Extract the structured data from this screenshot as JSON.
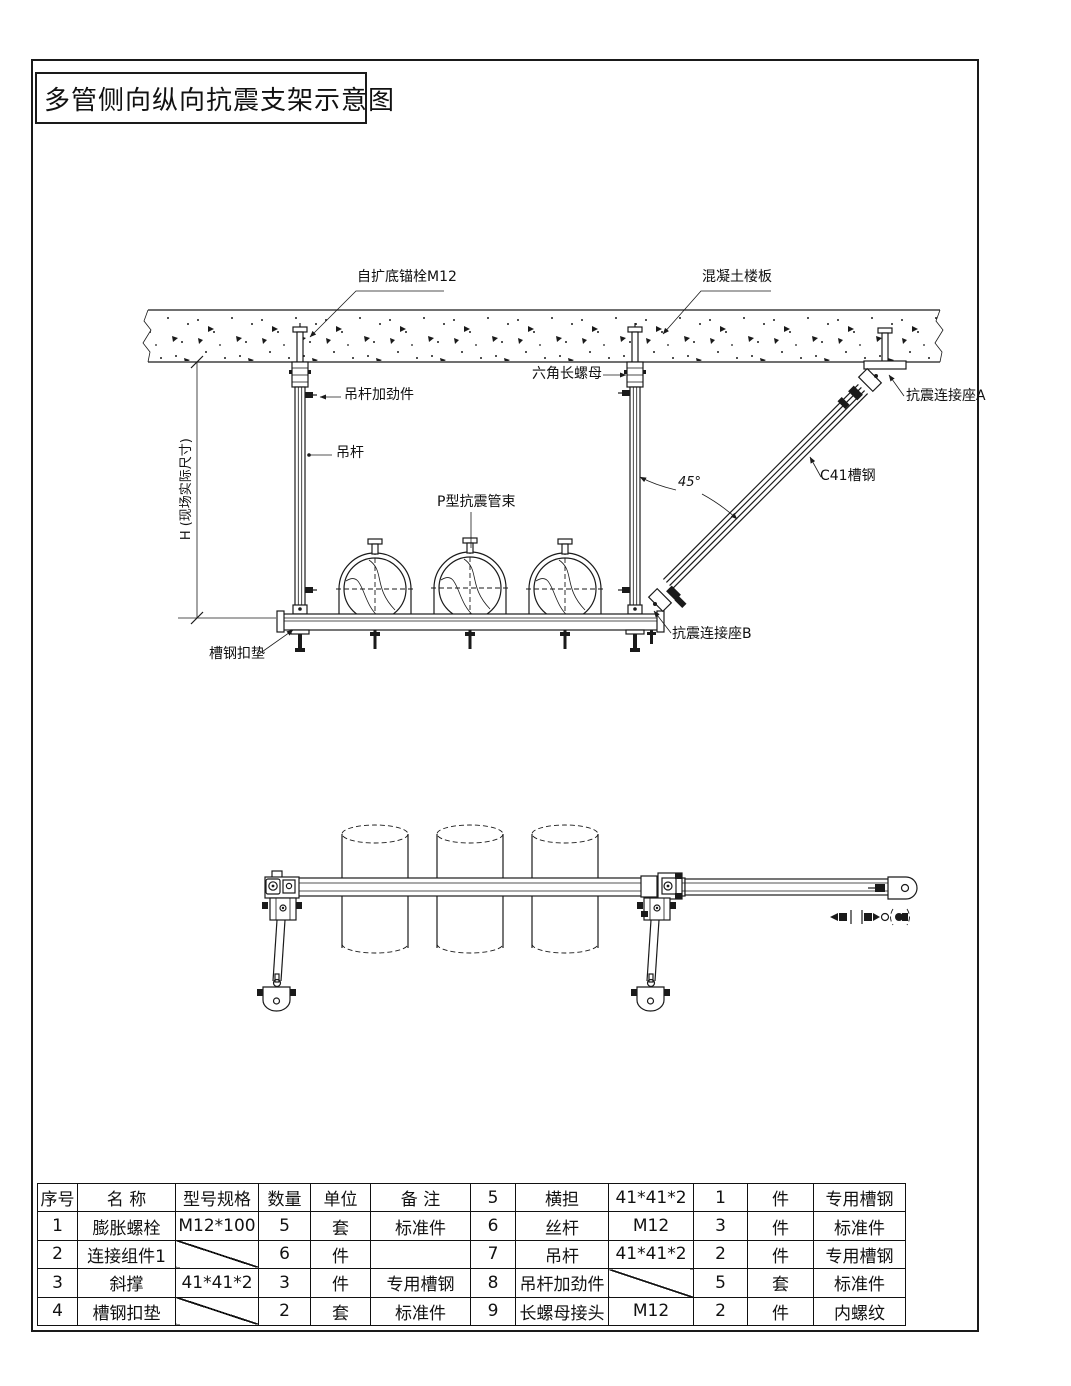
{
  "page": {
    "title": "多管侧向纵向抗震支架示意图"
  },
  "elevation": {
    "labels": {
      "anchor_bolt": "自扩底锚栓M12",
      "concrete_slab": "混凝土楼板",
      "hex_long_nut": "六角长螺母",
      "hanger_stiffener": "吊杆加劲件",
      "hanger_rod": "吊杆",
      "p_clamp": "P型抗震管束",
      "angle": "45°",
      "c41_channel": "C41槽钢",
      "seat_a": "抗震连接座A",
      "seat_b": "抗震连接座B",
      "channel_pad": "槽钢扣垫",
      "height_dim": "H (现场实际尺寸)"
    }
  },
  "table": {
    "rows": [
      [
        "序号",
        "名 称",
        "型号规格",
        "数量",
        "单位",
        "备 注",
        "5",
        "横担",
        "41*41*2",
        "1",
        "件",
        "专用槽钢"
      ],
      [
        "1",
        "膨胀螺栓",
        "M12*100",
        "5",
        "套",
        "标准件",
        "6",
        "丝杆",
        "M12",
        "3",
        "件",
        "标准件"
      ],
      [
        "2",
        "连接组件1",
        "",
        "6",
        "件",
        "",
        "7",
        "吊杆",
        "41*41*2",
        "2",
        "件",
        "专用槽钢"
      ],
      [
        "3",
        "斜撑",
        "41*41*2",
        "3",
        "件",
        "专用槽钢",
        "8",
        "吊杆加劲件",
        "",
        "5",
        "套",
        "标准件"
      ],
      [
        "4",
        "槽钢扣垫",
        "",
        "2",
        "套",
        "标准件",
        "9",
        "长螺母接头",
        "M12",
        "2",
        "件",
        "内螺纹"
      ]
    ],
    "diagonal_cells": [
      [
        2,
        2
      ],
      [
        4,
        2
      ],
      [
        3,
        8
      ]
    ]
  },
  "colors": {
    "line": "#1a1a1a",
    "background": "#ffffff"
  }
}
